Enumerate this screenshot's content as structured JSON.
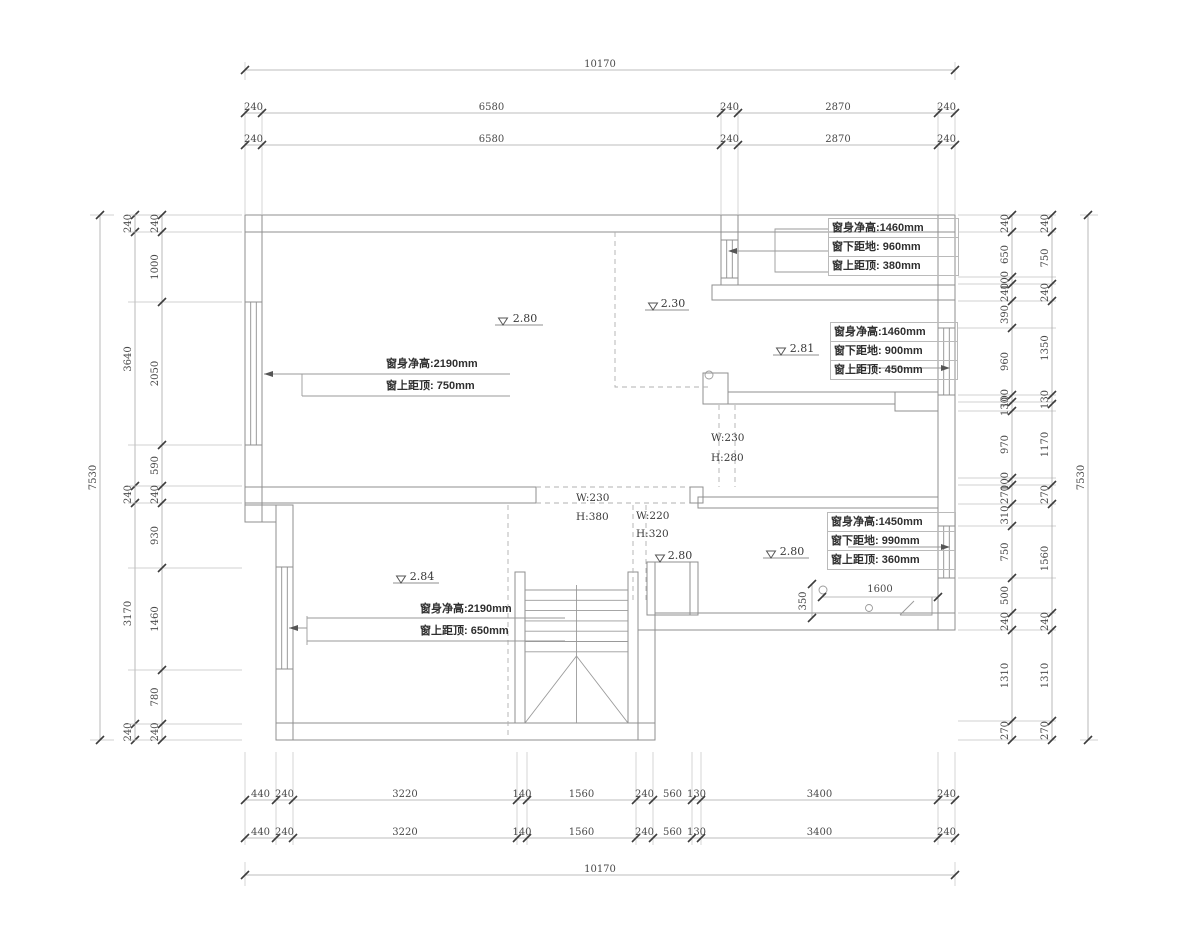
{
  "page": {
    "background": "#ffffff",
    "wall_line_color": "#8f8f8f",
    "dimension_text_color": "#4a4a4a",
    "annotation_text_color": "#2f2f2f"
  },
  "dims": {
    "top_overall": [
      "10170"
    ],
    "top_row_a": [
      "240",
      "6580",
      "240",
      "2870",
      "240"
    ],
    "top_row_b": [
      "240",
      "6580",
      "240",
      "2870",
      "240"
    ],
    "bottom_row_a": [
      "440",
      "240",
      "3220",
      "140",
      "1560",
      "240",
      "560",
      "130",
      "3400",
      "240"
    ],
    "bottom_row_b": [
      "440",
      "240",
      "3220",
      "140",
      "1560",
      "240",
      "560",
      "130",
      "3400",
      "240"
    ],
    "bottom_overall": [
      "10170"
    ],
    "left_overall": [
      "7530"
    ],
    "left_outer": [
      "240",
      "3640",
      "240",
      "3170",
      "240"
    ],
    "left_inner": [
      "240",
      "1000",
      "2050",
      "590",
      "240",
      "930",
      "1460",
      "780",
      "240"
    ],
    "right_inner": [
      "240",
      "650",
      "100",
      "240",
      "390",
      "960",
      "100",
      "130",
      "970",
      "100",
      "270",
      "310",
      "750",
      "500",
      "240",
      "1310",
      "270"
    ],
    "right_outer": [
      "240",
      "750",
      "240",
      "1350",
      "130",
      "1170",
      "270",
      "1560",
      "240",
      "1310",
      "270"
    ],
    "right_overall": [
      "7530"
    ]
  },
  "window_notes": {
    "top_right": [
      "窗身净高:1460mm",
      "窗下距地: 960mm",
      "窗上距顶: 380mm"
    ],
    "mid_right": [
      "窗身净高:1460mm",
      "窗下距地: 900mm",
      "窗上距顶: 450mm"
    ],
    "low_right": [
      "窗身净高:1450mm",
      "窗下距地: 990mm",
      "窗上距顶: 360mm"
    ],
    "left_upper": [
      "窗身净高:2190mm",
      "窗上距顶: 750mm"
    ],
    "left_lower": [
      "窗身净高:2190mm",
      "窗上距顶: 650mm"
    ]
  },
  "levels": [
    "2.80",
    "2.30",
    "2.81",
    "2.84",
    "2.80",
    "2.80"
  ],
  "openings": [
    [
      "W:230",
      "H:280"
    ],
    [
      "W:230",
      "H:380"
    ],
    [
      "W:220",
      "H:320"
    ]
  ],
  "stair_dims": {
    "width": "1600",
    "offset": "350"
  }
}
